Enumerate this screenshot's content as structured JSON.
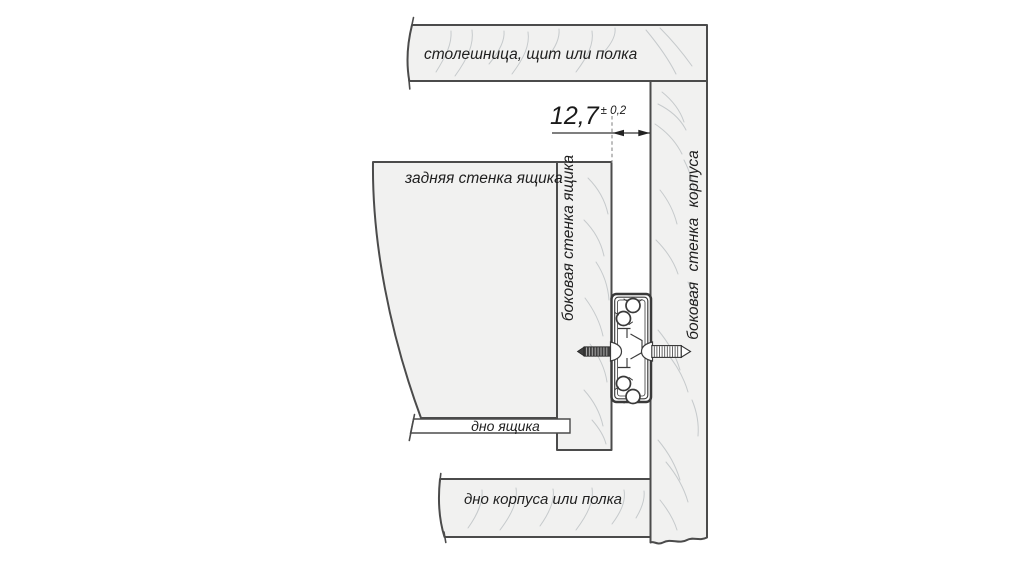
{
  "diagram": {
    "boards": {
      "top_board": {
        "label": "столешница, щит или полка"
      },
      "back_wall": {
        "label": "задняя стенка ящика"
      },
      "drawer_side_wall": {
        "label": "боковая стенка ящика"
      },
      "cabinet_side_wall": {
        "label": "боковая стенка корпуса"
      },
      "drawer_bottom": {
        "label": "дно ящика"
      },
      "cabinet_bottom": {
        "label": "дно корпуса или полка"
      }
    },
    "dimension": {
      "value": "12,7",
      "tolerance": "± 0,2"
    },
    "hardware": {
      "slide_icon": "drawer-slide-cross-section",
      "left_screw_icon": "mounting-screw",
      "right_screw_icon": "mounting-screw"
    },
    "colors": {
      "board_fill": "#f1f1f0",
      "edge": "#4b4b4b",
      "grain": "#c6cacc",
      "text": "#1f1f1f",
      "slide": "#3a3a3a",
      "dash": "#7d7d7d"
    }
  }
}
